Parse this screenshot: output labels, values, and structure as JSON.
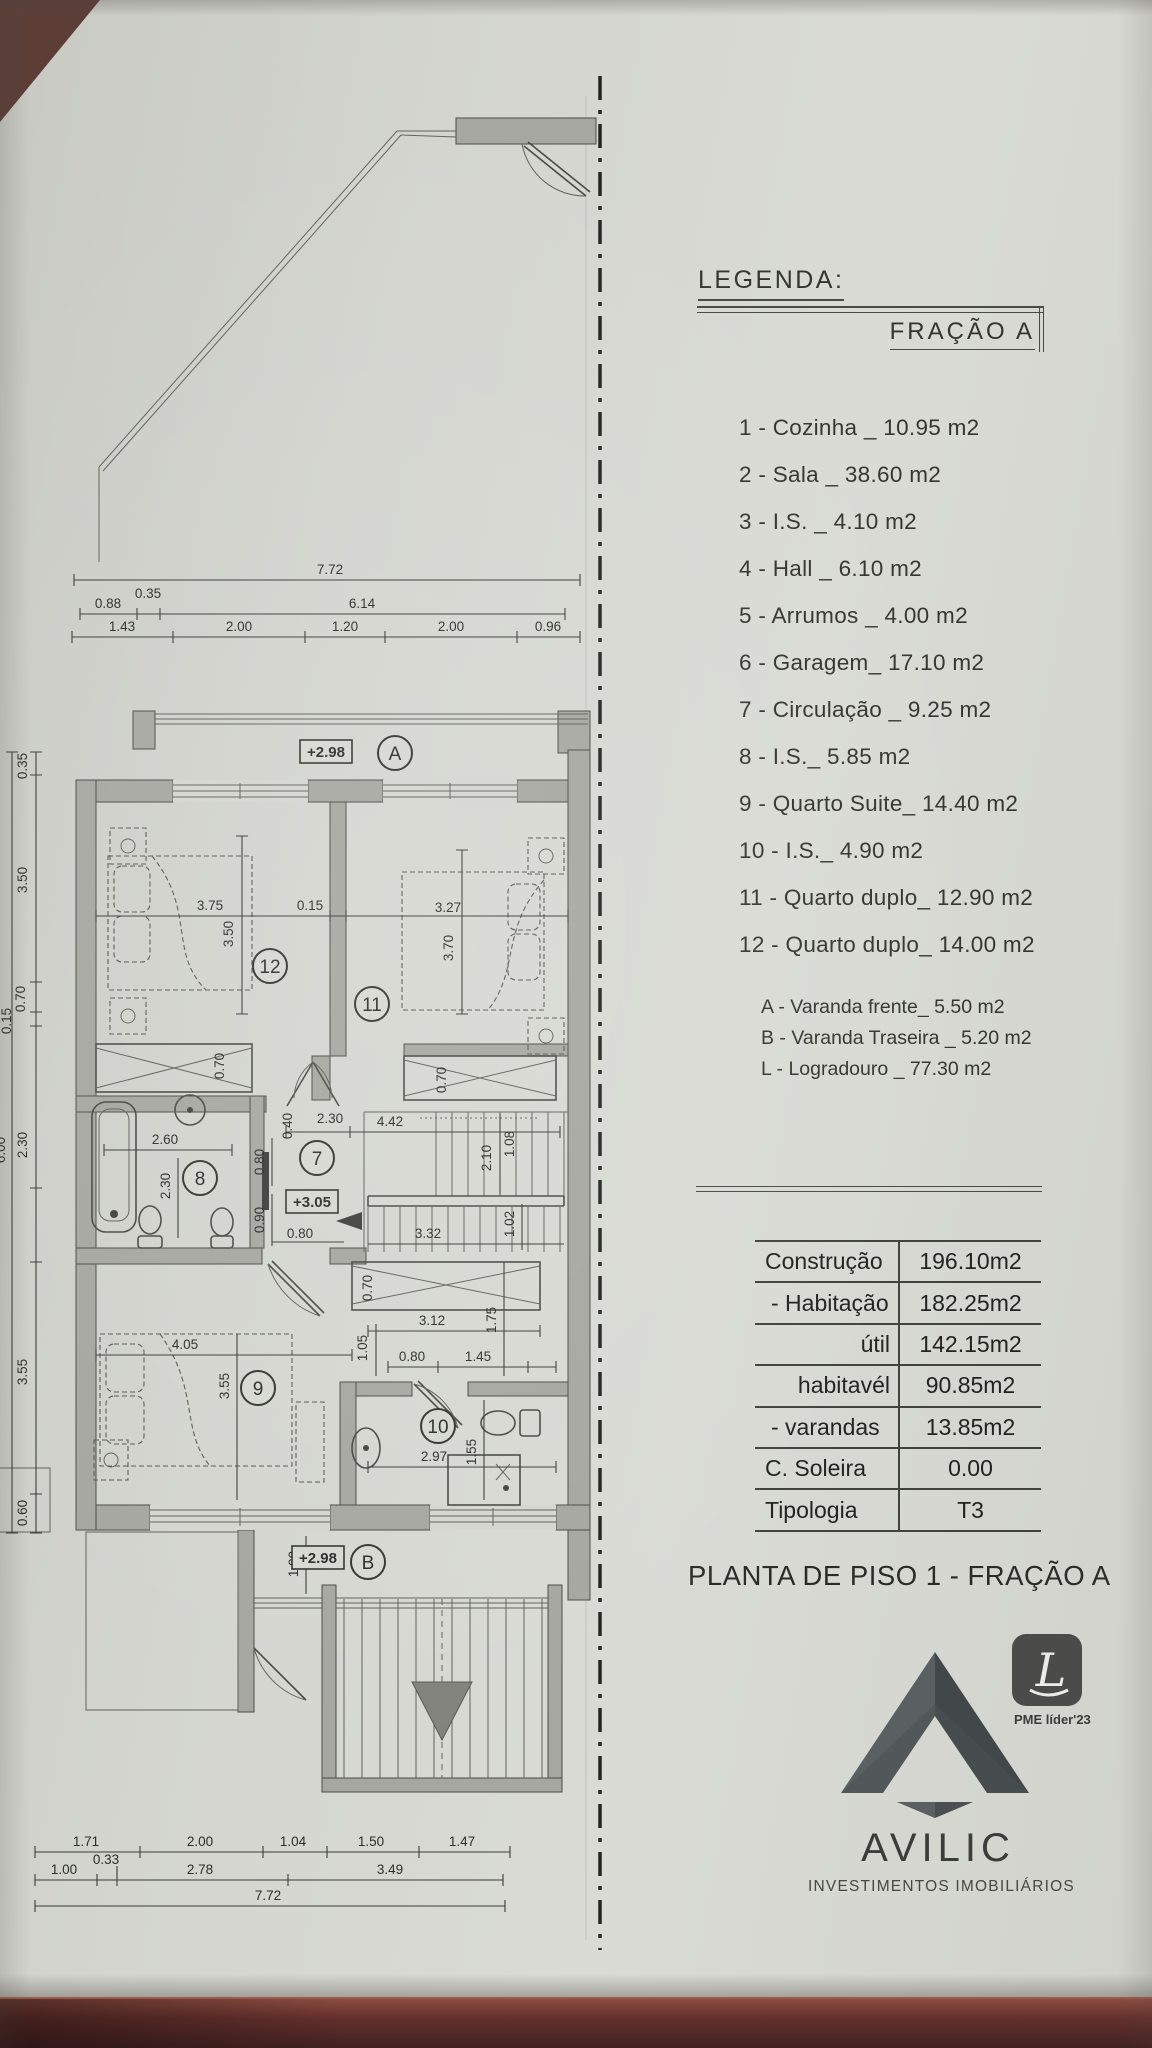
{
  "legend": {
    "title": "LEGENDA:",
    "fraction": "FRAÇÃO A",
    "items": [
      "1 - Cozinha _ 10.95 m2",
      "2 - Sala _ 38.60 m2",
      "3 - I.S. _ 4.10 m2",
      "4 - Hall _ 6.10 m2",
      "5 - Arrumos _ 4.00 m2",
      "6 - Garagem_ 17.10 m2",
      "7 - Circulação _ 9.25 m2",
      "8 - I.S._ 5.85 m2",
      "9 - Quarto Suite_ 14.40 m2",
      "10 - I.S._ 4.90 m2",
      "11 - Quarto duplo_ 12.90 m2",
      "12 - Quarto duplo_ 14.00 m2"
    ],
    "extras": [
      "A - Varanda frente_ 5.50 m2",
      "B - Varanda Traseira _ 5.20 m2",
      "L - Logradouro _ 77.30 m2"
    ]
  },
  "areas_table": {
    "rows": [
      {
        "label": "Construção",
        "value": "196.10m2"
      },
      {
        "label": "- Habitação",
        "value": "182.25m2"
      },
      {
        "label": "útil",
        "value": "142.15m2"
      },
      {
        "label": "habitavél",
        "value": "90.85m2"
      },
      {
        "label": "- varandas",
        "value": "13.85m2"
      },
      {
        "label": "C. Soleira",
        "value": "0.00"
      },
      {
        "label": "Tipologia",
        "value": "T3"
      }
    ]
  },
  "plan_title": "PLANTA DE PISO 1 - FRAÇÃO A",
  "branding": {
    "name": "AVILIC",
    "tagline": "INVESTIMENTOS IMOBILIÁRIOS",
    "badge_letter": "L",
    "badge_caption": "PME líder'23"
  },
  "plan": {
    "marks": {
      "balcony_a": "A",
      "balcony_b": "B"
    },
    "rooms": [
      "12",
      "11",
      "7",
      "8",
      "9",
      "10"
    ],
    "levels": [
      "+2.98",
      "+3.05",
      "+2.98"
    ],
    "dims_top": [
      "7.72",
      "0.88",
      "0.35",
      "6.14",
      "1.43",
      "2.00",
      "1.20",
      "2.00",
      "0.96"
    ],
    "dims_left": [
      "0.35",
      "3.50",
      "0.70",
      "0.15",
      "2.30",
      "3.55",
      "0.60",
      "6.00"
    ],
    "dims_bottom": [
      "1.71",
      "2.00",
      "1.04",
      "1.50",
      "1.47",
      "1.00",
      "0.33",
      "2.78",
      "3.49",
      "7.72"
    ],
    "dims_bedrooms": [
      "3.75",
      "0.15",
      "3.27",
      "3.50",
      "3.70",
      "0.70",
      "0.70"
    ],
    "dims_bath8": [
      "2.60",
      "2.30"
    ],
    "dims_hall": [
      "0.40",
      "2.30",
      "4.42",
      "0.80",
      "0.90",
      "0.80"
    ],
    "dims_stairs": [
      "2.10",
      "1.08",
      "1.02",
      "3.32"
    ],
    "dims_suite": [
      "4.05",
      "3.55",
      "1.05",
      "0.70",
      "3.12",
      "1.75"
    ],
    "dims_bath10": [
      "0.80",
      "1.45",
      "2.97",
      "1.55"
    ],
    "dims_balcony_b": [
      "1.00"
    ]
  }
}
